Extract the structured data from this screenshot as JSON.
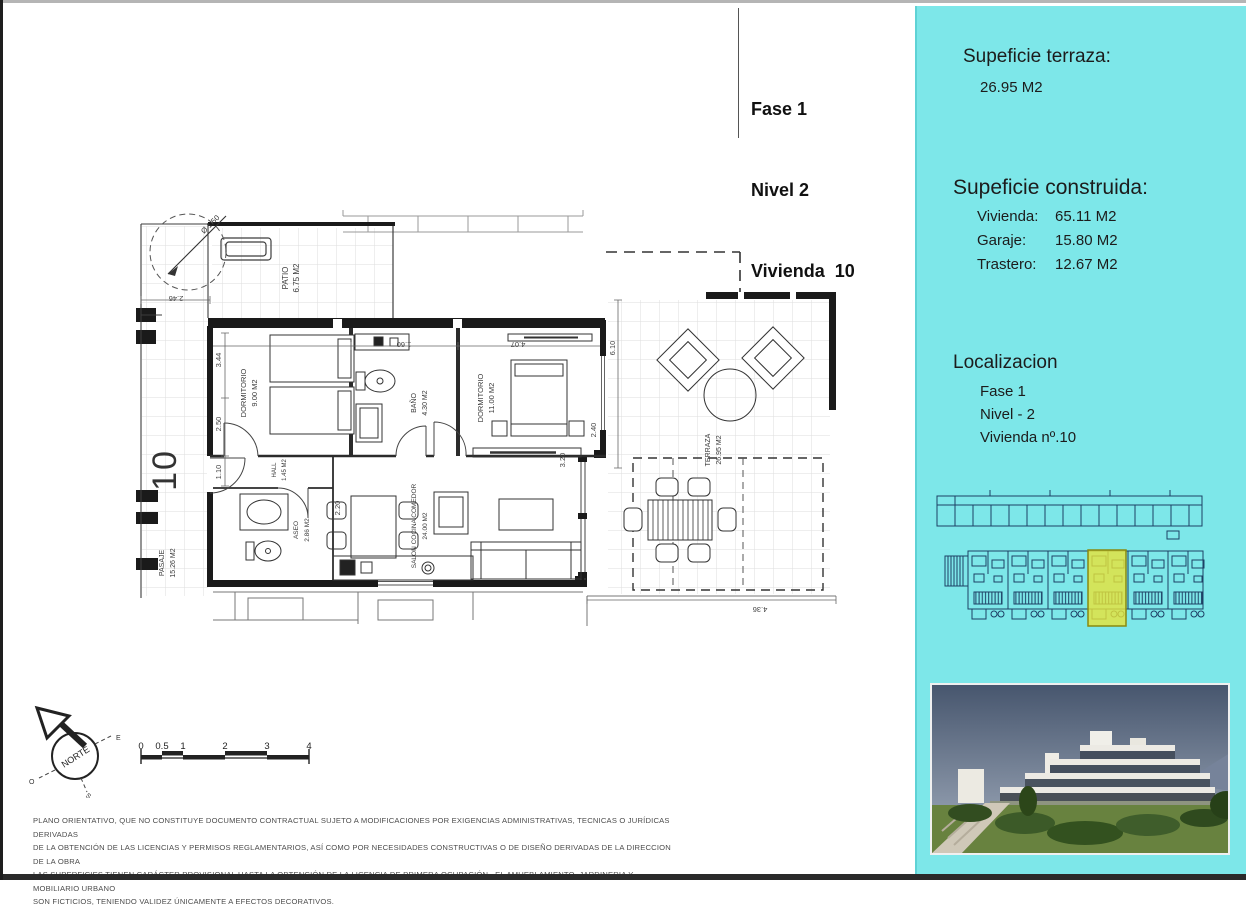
{
  "title_block": {
    "line1": "Fase 1",
    "line2": "Nivel 2",
    "line3": "Vivienda  10"
  },
  "panel": {
    "bg_color": "#7de7e9",
    "terrace_heading": "Supeficie terraza:",
    "terrace_value": "26.95 M2",
    "built_heading": "Supeficie construida:",
    "built_rows": [
      {
        "label": "Vivienda:",
        "value": "65.11 M2"
      },
      {
        "label": "Garaje:",
        "value": "15.80 M2"
      },
      {
        "label": "Trastero:",
        "value": "12.67 M2"
      }
    ],
    "location_heading": "Localizacion",
    "location_lines": [
      "Fase 1",
      "Nivel - 2",
      "Vivienda nº.10"
    ],
    "highlight_color": "#e8e437"
  },
  "floor_plan": {
    "unit_number": "10",
    "rooms": {
      "pasaje": {
        "name": "PASAJE",
        "area": "15.26 M2"
      },
      "patio": {
        "name": "PATIO",
        "area": "6.75 M2"
      },
      "dorm1": {
        "name": "DORMITORIO",
        "area": "9.00 M2"
      },
      "bano": {
        "name": "BAÑO",
        "area": "4.30 M2"
      },
      "dorm2": {
        "name": "DORMITORIO",
        "area": "11.00 M2"
      },
      "terraza": {
        "name": "TERRAZA",
        "area": "26.95 M2"
      },
      "salon": {
        "name": "SALON COCINA COMEDOR",
        "area": "24.00 M2"
      },
      "aseo": {
        "name": "ASEO",
        "area": "2.86 M2"
      },
      "hall": {
        "name": "HALL",
        "area": "1.45 M2"
      }
    },
    "dims": {
      "patio_w": "2.46",
      "d344": "3.44",
      "d250": "2.50",
      "d110": "1.10",
      "d160": "1.60",
      "d407": "4.07",
      "d610": "6.10",
      "d240": "2.40",
      "d320": "3.20",
      "d220": "2.20",
      "d436": "4.36",
      "radius": "Ø 1.50"
    }
  },
  "compass": {
    "label": "NORTE",
    "east": "E",
    "west": "O",
    "south": "S"
  },
  "scale_bar": {
    "ticks": [
      "0",
      "0.5",
      "1",
      "2",
      "3",
      "4"
    ]
  },
  "disclaimer": {
    "lines": [
      "PLANO ORIENTATIVO, QUE NO CONSTITUYE DOCUMENTO CONTRACTUAL SUJETO A MODIFICACIONES POR EXIGENCIAS ADMINISTRATIVAS, TECNICAS O JURÍDICAS DERIVADAS",
      "DE LA OBTENCIÓN DE LAS LICENCIAS Y PERMISOS REGLAMENTARIOS, ASÍ COMO POR NECESIDADES CONSTRUCTIVAS  O DE DISEÑO DERIVADAS DE LA DIRECCION DE LA OBRA",
      "LAS SUPERFICIES TIENEN CARÁCTER PROVISIONAL HASTA LA OBTENCIÓN DE LA LICENCIA DE PRIMERA OCUPACIÓN , EL AMUEBLAMIENTO, JARDINERIA Y MOBILIARIO URBANO",
      "SON FICTICIOS, TENIENDO VALIDEZ ÚNICAMENTE  A EFECTOS DECORATIVOS."
    ]
  }
}
